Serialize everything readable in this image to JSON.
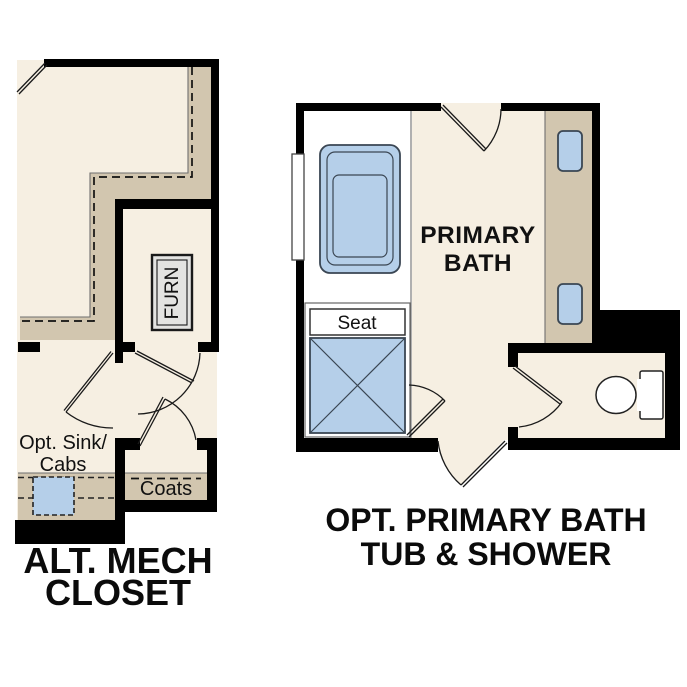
{
  "canvas": {
    "width": 687,
    "height": 687,
    "background": "#ffffff"
  },
  "colors": {
    "wall_black": "#000000",
    "floor_cream": "#f6efe2",
    "cabinet_tan": "#d2c6af",
    "fixture_blue": "#b5cfe9",
    "fixture_outline": "#3a4653",
    "fixture_white": "#ffffff"
  },
  "left_plan": {
    "title_line1": "ALT. MECH",
    "title_line2": "CLOSET",
    "furnace_label": "FURN",
    "opt_sink_label_line1": "Opt. Sink/",
    "opt_sink_label_line2": "Cabs",
    "coats_label": "Coats"
  },
  "right_plan": {
    "title_line1": "OPT. PRIMARY BATH",
    "title_line2": "TUB & SHOWER",
    "room_label_line1": "PRIMARY",
    "room_label_line2": "BATH",
    "seat_label": "Seat"
  }
}
